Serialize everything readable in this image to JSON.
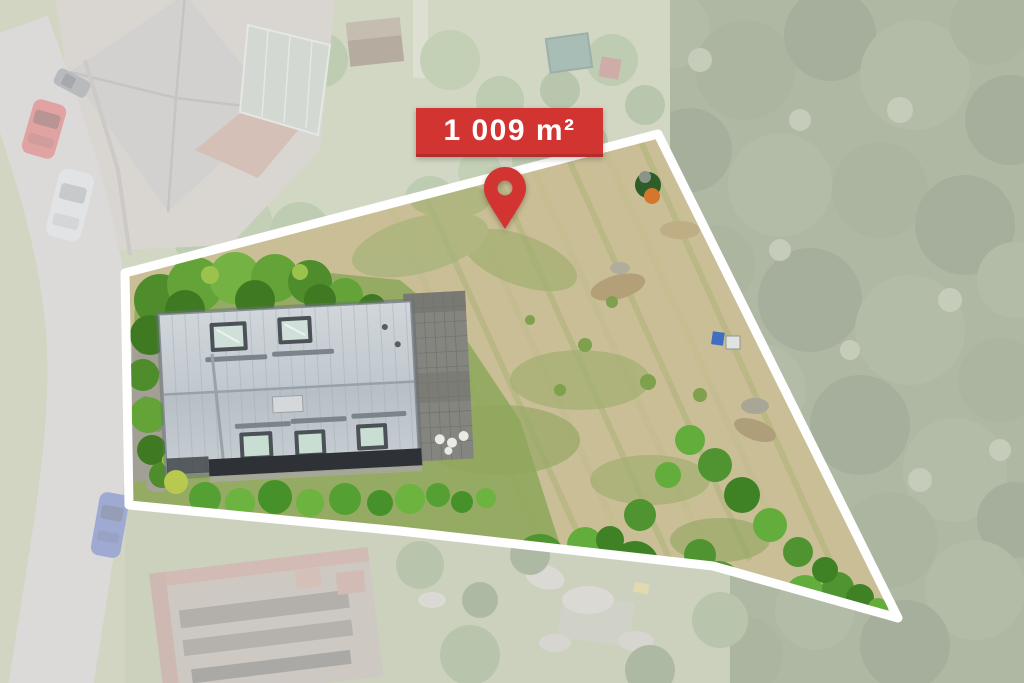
{
  "overlay": {
    "area_label": "1 009 m²",
    "marker_icon": "map-pin"
  },
  "colors": {
    "accent_red": "#d23432",
    "accent_red_dark": "#b22e2c",
    "outline_white": "#ffffff",
    "label_text": "#ffffff"
  },
  "scene": {
    "kind": "aerial-drone-photo-of-building-plot",
    "visible_objects": [
      "white-plot-boundary",
      "house-with-light-gray-metal-roof",
      "roof-skylights",
      "paved-terrace-with-chairs",
      "garden-lawn-and-bushes",
      "dry-meadow",
      "street-with-parked-cars",
      "neighboring-houses",
      "forest"
    ]
  }
}
